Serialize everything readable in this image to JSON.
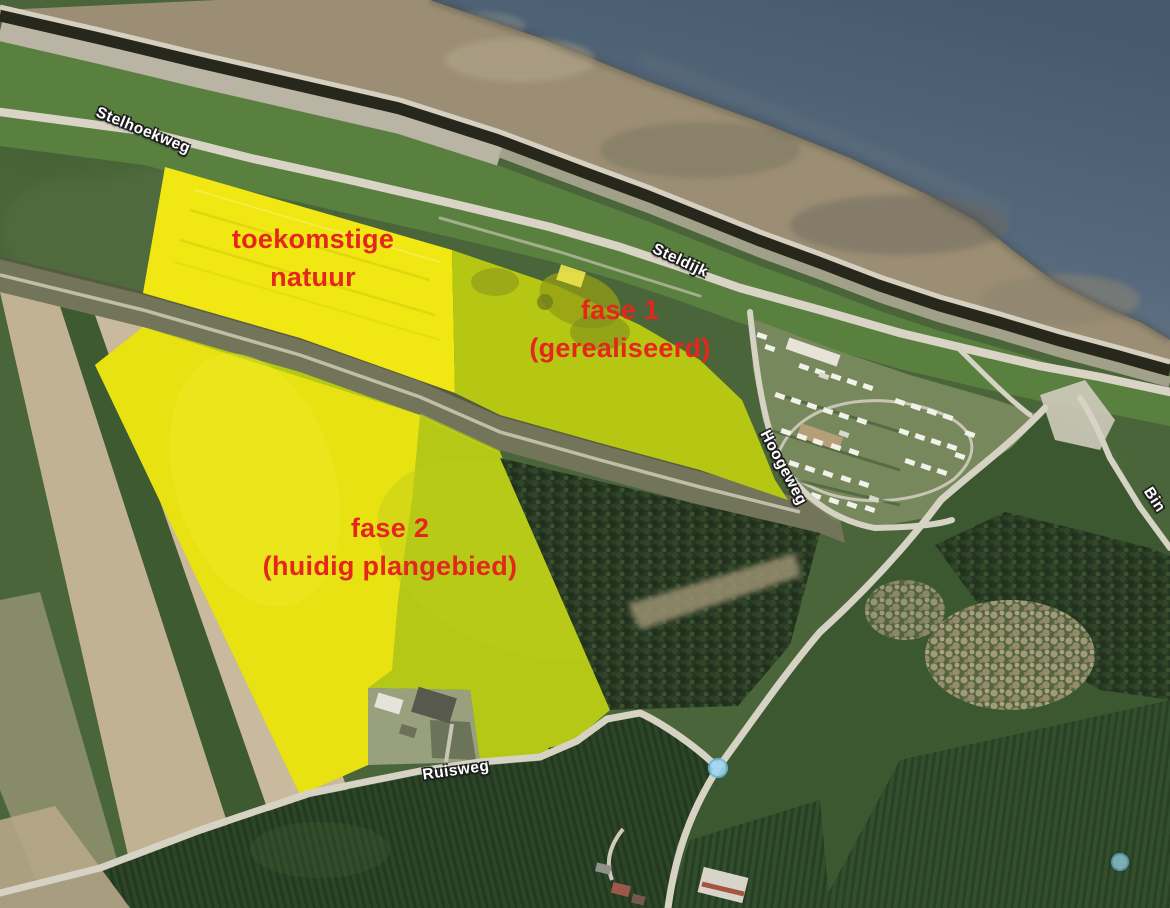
{
  "map": {
    "kind": "satellite-aerial-annotation",
    "area_labels": {
      "natuur": {
        "line1": "toekomstige",
        "line2": "natuur"
      },
      "fase1": {
        "line1": "fase 1",
        "line2": "(gerealiseerd)"
      },
      "fase2": {
        "line1": "fase 2",
        "line2": "(huidig plangebied)"
      }
    },
    "road_labels": {
      "stelhoekweg": "Stelhoekweg",
      "steldijk": "Steldijk",
      "hoogeweg": "Hoogeweg",
      "ruisweg": "Ruisweg",
      "bin_partial": "Bin"
    },
    "colors": {
      "label_red": "#e5261c",
      "highlight_yellow": "#e9e212",
      "highlight_chartreuse": "#b5c816",
      "water": "#56697c",
      "marker_blue": "#9fd8f2",
      "road_text": "#ffffff"
    },
    "markers": [
      "poi-dot-west",
      "poi-dot-east"
    ]
  }
}
